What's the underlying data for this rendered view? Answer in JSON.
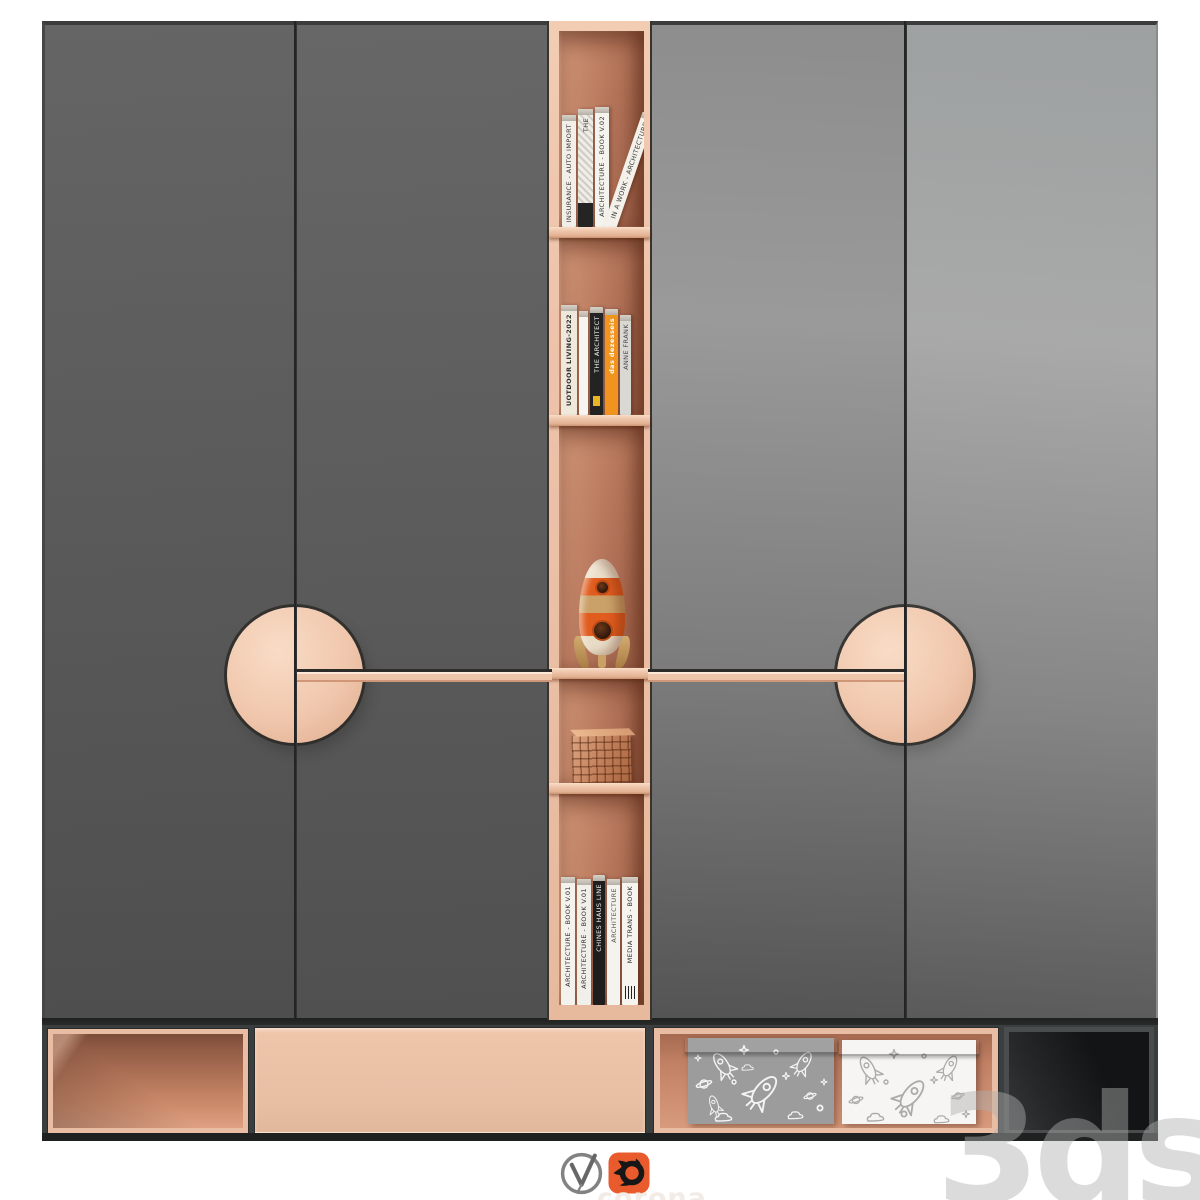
{
  "colors": {
    "background": "#ffffff",
    "door_dark_gray": "#5b5b5b",
    "door_light_gray": "#a0a0a0",
    "accent_pink": "#eec3a9",
    "shelf_interior": "#b5755c",
    "base_dark": "#3b3e3f",
    "rocket_orange": "#e05c1f",
    "cube_copper": "#c07d58",
    "box_gray": "#9c9c9c",
    "box_white": "#f6f5f3"
  },
  "shelf": {
    "niche_top": {
      "books": [
        {
          "label": "INSURANCE - AUTO IMPORT",
          "spine": "#f1efe8"
        },
        {
          "label": "THE",
          "spine": "#efede6",
          "pattern": "hatch"
        },
        {
          "label": "ARCHITECTURE - BOOK V.02",
          "spine": "#f5f3ed"
        },
        {
          "label": "IN A WORK - ARCHITECTURE",
          "spine": "#f3f1ea",
          "leaning": true
        }
      ]
    },
    "niche_mid": {
      "books": [
        {
          "label": "UOTDOOR LIVING-2022",
          "spine": "#efe9dc"
        },
        {
          "label": "",
          "spine": "#f7f5f1"
        },
        {
          "label": "THE ARCHITECT",
          "spine": "#232323",
          "mark": "#e8b525"
        },
        {
          "label": "das dezesseis",
          "spine": "#f0941f"
        },
        {
          "label": "ANNE FRANK",
          "spine": "#d9d8d3"
        }
      ]
    },
    "niche_rocket": {
      "object": "rocket-toy"
    },
    "niche_cube": {
      "object": "studded-cube"
    },
    "niche_bottom": {
      "books": [
        {
          "label": "ARCHITECTURE - BOOK V.01",
          "spine": "#f4f2ec"
        },
        {
          "label": "ARCHITECTURE - BOOK V.01",
          "spine": "#f1efe9"
        },
        {
          "label": "CHINES HAUS LINE",
          "spine": "#1e1e1e"
        },
        {
          "label": "ARCHITECTURE",
          "spine": "#f5f3ee"
        },
        {
          "label": "MEDIA TRANS - BOOK",
          "spine": "#f6f4ef",
          "barcode": true
        }
      ]
    }
  },
  "base": {
    "boxes": [
      {
        "name": "storage-box-gray",
        "pattern": "space-doodles",
        "color": "#9c9c9c"
      },
      {
        "name": "storage-box-white",
        "pattern": "space-doodles",
        "color": "#f6f5f3"
      }
    ]
  },
  "watermark": {
    "text": "3dsky"
  },
  "footer": {
    "corona_label": "corona",
    "logos": [
      "v-ray",
      "corona-renderer"
    ]
  }
}
